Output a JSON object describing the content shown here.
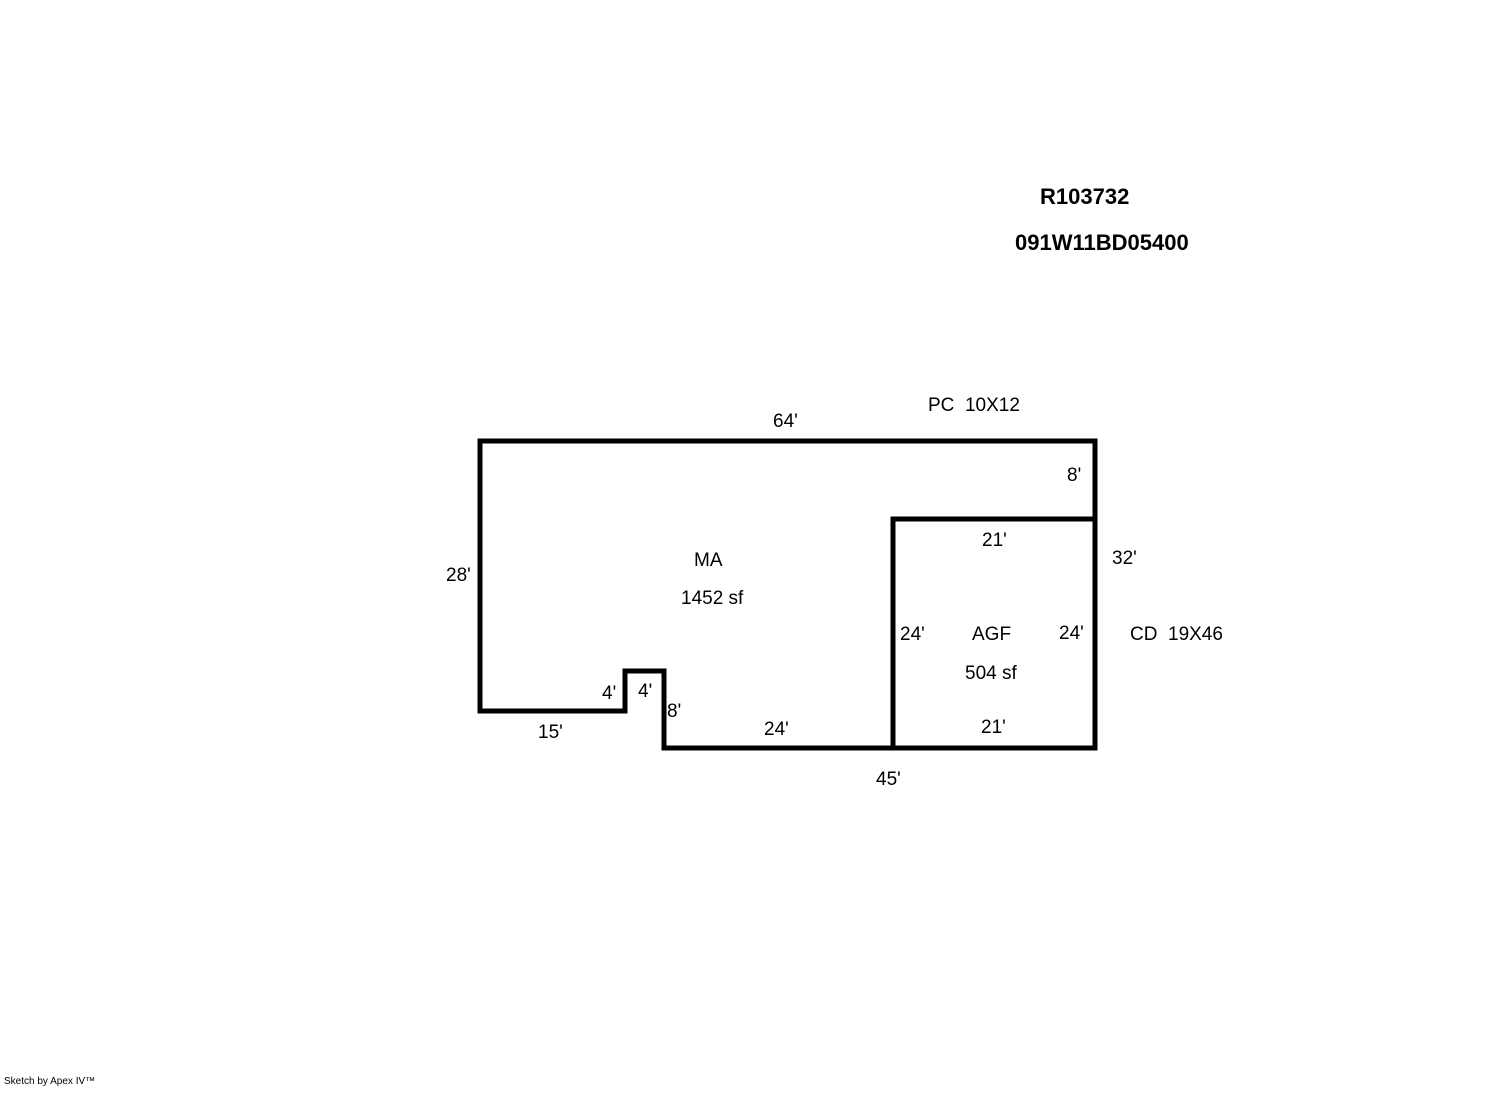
{
  "header": {
    "record_id": "R103732",
    "parcel_id": "091W11BD05400"
  },
  "sketch": {
    "main_area": {
      "code": "MA",
      "area": "1452 sf"
    },
    "garage": {
      "code": "AGF",
      "area": "504 sf"
    },
    "notes": {
      "porch": "PC  10X12",
      "carport_deck": "CD  19X46"
    },
    "dims": {
      "top": "64'",
      "right_upper": "8'",
      "right_total": "32'",
      "left": "28'",
      "agf_top": "21'",
      "agf_left": "24'",
      "agf_right": "24'",
      "agf_bottom": "21'",
      "notch_left": "4'",
      "notch_top": "4'",
      "notch_right": "8'",
      "bottom_left": "15'",
      "bottom_mid": "24'",
      "bottom_total": "45'"
    },
    "line_color": "#000000",
    "background_color": "#ffffff"
  },
  "footer": {
    "credit": "Sketch by Apex IV™"
  }
}
